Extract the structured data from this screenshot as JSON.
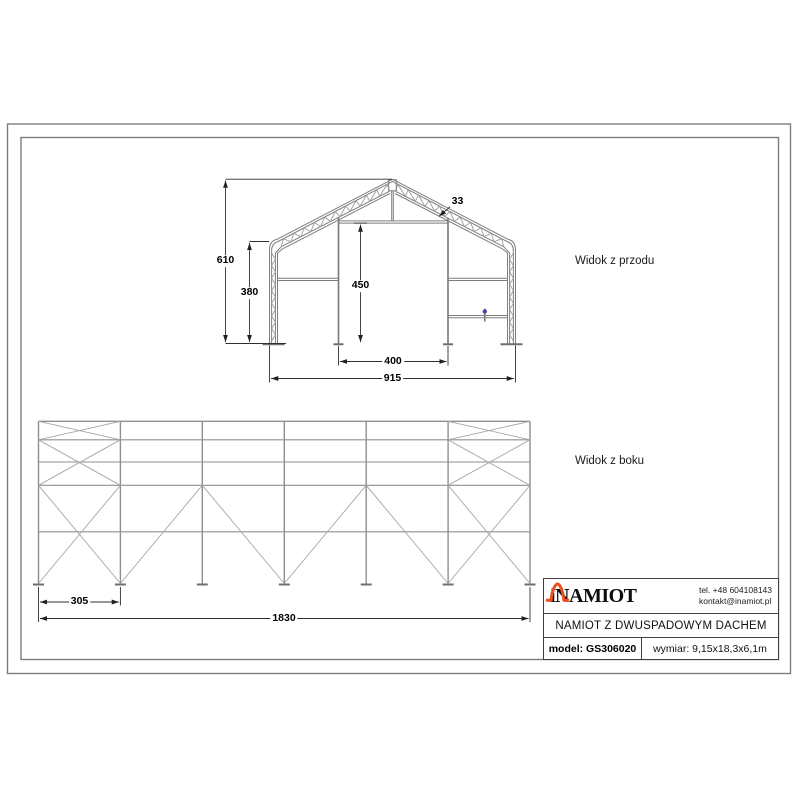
{
  "drawing": {
    "front_view": {
      "label": "Widok z przodu",
      "dims": {
        "total_height": "610",
        "side_wall_height": "380",
        "door_height": "450",
        "door_width": "400",
        "total_width": "915",
        "truss_depth": "33"
      }
    },
    "side_view": {
      "label": "Widok z boku",
      "dims": {
        "bay_spacing": "305",
        "total_length": "1830"
      }
    }
  },
  "title_block": {
    "brand": "iNAMIOT",
    "phone": "tel. +48 604108143",
    "email": "kontakt@inamiot.pl",
    "product_name": "NAMIOT Z DWUSPADOWYM DACHEM",
    "model": "model: GS306020",
    "size": "wymiar: 9,15x18,3x6,1m"
  },
  "icons": {
    "logo_icon": "tent-house-outline"
  },
  "colors": {
    "accent_orange": "#E8501E",
    "drawing_line_gray": "#8E8E8E",
    "dimension_color": "#2F2F2F",
    "border_gray": "#7D7D7D"
  }
}
